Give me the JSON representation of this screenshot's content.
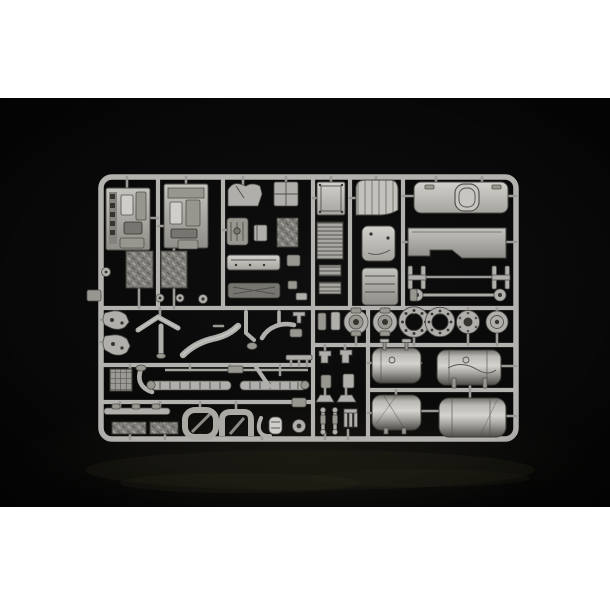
{
  "image": {
    "type": "product-photograph",
    "subject": "Light grey injection-moulded plastic sprue (model kit parts tree) with truck model components, photographed on a black studio background",
    "kit_scale_hint": "large-scale truck model sprue"
  },
  "colors": {
    "page_bg": "#ffffff",
    "photo_bg": "#060606",
    "rail": "#b3b2ae",
    "gate": "#9a9995",
    "plastic": "#b0afab",
    "plastic_light": "#cfceca",
    "plastic_mid": "#98978f",
    "plastic_dark": "#76756f",
    "edge": "#504f4b",
    "edge_dark": "#35342f",
    "floor_tint": "#2e2a1c"
  },
  "scene": {
    "background": "black backdrop with faint floor sheen at bottom",
    "sprue": "single rectangular grey sprue frame with internal cross rails, rounded corners",
    "objects": [
      {
        "name": "cab interior side panel",
        "count": 2,
        "where": "top left"
      },
      {
        "name": "diamond tread-plate panel",
        "count": 2,
        "where": "upper left, below side panels"
      },
      {
        "name": "engine / seat base blocks",
        "count": 4,
        "where": "upper middle-left column"
      },
      {
        "name": "door sill strips",
        "count": 2,
        "where": "middle-left column"
      },
      {
        "name": "riveted flat panel",
        "count": 1,
        "where": "top centre"
      },
      {
        "name": "radiator grille panel",
        "count": 1,
        "where": "centre"
      },
      {
        "name": "ribbed intake strips",
        "count": 2,
        "where": "centre"
      },
      {
        "name": "wind deflector panel",
        "count": 1,
        "where": "top centre-right"
      },
      {
        "name": "rounded storage box",
        "count": 2,
        "where": "centre column"
      },
      {
        "name": "cab roof panel with sunroof hatch",
        "count": 1,
        "where": "top right"
      },
      {
        "name": "cab rear/floor panel with notch",
        "count": 1,
        "where": "top right, below roof"
      },
      {
        "name": "spring hanger I-brackets",
        "count": 2,
        "where": "right, mid height"
      },
      {
        "name": "steering tie rod with ball ends",
        "count": 1,
        "where": "right, mid height"
      },
      {
        "name": "wheel hubs / brake drums / bolt-hole rings",
        "count": 6,
        "where": "row across lower right"
      },
      {
        "name": "cylindrical fuel tank",
        "count": 4,
        "where": "lower right, two rows of two"
      },
      {
        "name": "exhaust and coolant pipes",
        "count": 8,
        "where": "lower left"
      },
      {
        "name": "leaf-spring brackets",
        "count": 2,
        "where": "lower far left"
      },
      {
        "name": "waffle grid plate",
        "count": 1,
        "where": "lower left"
      },
      {
        "name": "ribbed axle shafts",
        "count": 2,
        "where": "lower left band"
      },
      {
        "name": "textured step mats",
        "count": 2,
        "where": "bottom left"
      },
      {
        "name": "mudguard loops",
        "count": 3,
        "where": "bottom centre"
      },
      {
        "name": "small muffler and fittings",
        "count": 1,
        "where": "bottom centre"
      },
      {
        "name": "shock absorbers and small brackets",
        "count": 6,
        "where": "column left of fuel tanks"
      }
    ]
  }
}
